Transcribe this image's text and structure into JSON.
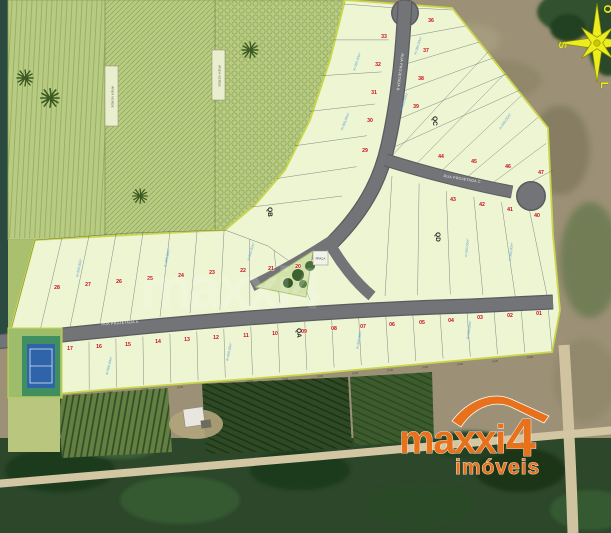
{
  "map": {
    "compass": {
      "top": "O",
      "left": "S",
      "bottom": "L",
      "right": "N"
    },
    "quadra_labels": [
      "QA",
      "QB",
      "QC",
      "QD"
    ],
    "area_labels": [
      "ÁREA VERDE",
      "ÁREA VERDE"
    ],
    "praca_label": "PRAÇA",
    "street_labels": [
      "RUA PROJETADA A",
      "RUA PROJETADA B",
      "RUA PROJETADA C"
    ],
    "lot_area_label": "A=360,00m²",
    "dimension_label": "10,00",
    "watermark": "maxxi4",
    "lots": [
      {
        "n": "33",
        "x": 384,
        "y": 38
      },
      {
        "n": "32",
        "x": 378,
        "y": 66
      },
      {
        "n": "31",
        "x": 374,
        "y": 94
      },
      {
        "n": "30",
        "x": 370,
        "y": 122
      },
      {
        "n": "29",
        "x": 365,
        "y": 152
      },
      {
        "n": "36",
        "x": 431,
        "y": 22
      },
      {
        "n": "37",
        "x": 426,
        "y": 52
      },
      {
        "n": "38",
        "x": 421,
        "y": 80
      },
      {
        "n": "39",
        "x": 416,
        "y": 108
      },
      {
        "n": "44",
        "x": 441,
        "y": 158
      },
      {
        "n": "45",
        "x": 474,
        "y": 163
      },
      {
        "n": "46",
        "x": 508,
        "y": 168
      },
      {
        "n": "47",
        "x": 541,
        "y": 174
      },
      {
        "n": "43",
        "x": 453,
        "y": 201
      },
      {
        "n": "42",
        "x": 482,
        "y": 206
      },
      {
        "n": "41",
        "x": 510,
        "y": 211
      },
      {
        "n": "40",
        "x": 537,
        "y": 217
      },
      {
        "n": "28",
        "x": 57,
        "y": 289
      },
      {
        "n": "27",
        "x": 88,
        "y": 286
      },
      {
        "n": "26",
        "x": 119,
        "y": 283
      },
      {
        "n": "25",
        "x": 150,
        "y": 280
      },
      {
        "n": "24",
        "x": 181,
        "y": 277
      },
      {
        "n": "23",
        "x": 212,
        "y": 274
      },
      {
        "n": "22",
        "x": 243,
        "y": 272
      },
      {
        "n": "21",
        "x": 271,
        "y": 270
      },
      {
        "n": "20",
        "x": 298,
        "y": 268
      },
      {
        "n": "17",
        "x": 70,
        "y": 350
      },
      {
        "n": "16",
        "x": 99,
        "y": 348
      },
      {
        "n": "15",
        "x": 128,
        "y": 346
      },
      {
        "n": "14",
        "x": 158,
        "y": 343
      },
      {
        "n": "13",
        "x": 187,
        "y": 341
      },
      {
        "n": "12",
        "x": 216,
        "y": 339
      },
      {
        "n": "11",
        "x": 246,
        "y": 337
      },
      {
        "n": "10",
        "x": 275,
        "y": 335
      },
      {
        "n": "09",
        "x": 304,
        "y": 333
      },
      {
        "n": "08",
        "x": 334,
        "y": 330
      },
      {
        "n": "07",
        "x": 363,
        "y": 328
      },
      {
        "n": "06",
        "x": 392,
        "y": 326
      },
      {
        "n": "05",
        "x": 422,
        "y": 324
      },
      {
        "n": "04",
        "x": 451,
        "y": 322
      },
      {
        "n": "03",
        "x": 480,
        "y": 319
      },
      {
        "n": "02",
        "x": 510,
        "y": 317
      },
      {
        "n": "01",
        "x": 539,
        "y": 315
      }
    ]
  },
  "logo": {
    "name": "maxxi",
    "number": "4",
    "tagline": "imóveis"
  },
  "colors": {
    "accent_orange": "#e8721c",
    "compass_yellow": "#ecec1e",
    "lot_fill": "#edf5d3",
    "boundary_yellow": "#c9d64b",
    "road_gray": "#737478",
    "lot_number_red": "#c11212",
    "area_text_blue": "#5b9bd5",
    "park_green": "#b7cb82",
    "forest_green": "#2c472a",
    "field_tan": "#9c9176"
  }
}
